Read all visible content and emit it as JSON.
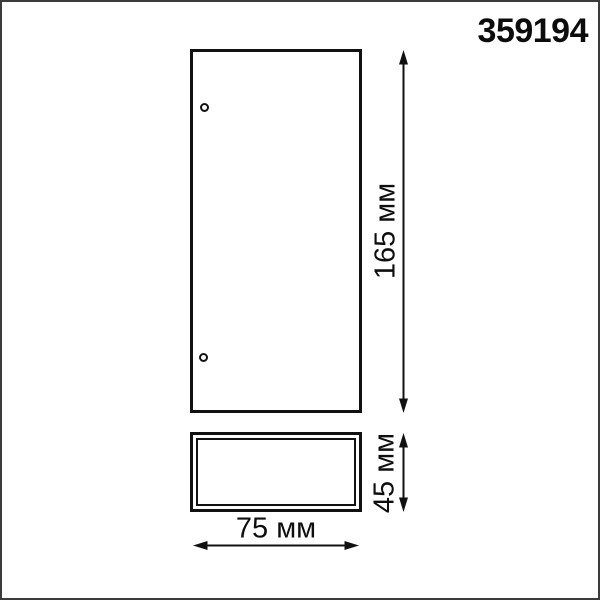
{
  "product": {
    "code": "359194"
  },
  "drawing": {
    "views": {
      "front": "front-view-outline",
      "side": "side-view-outline"
    },
    "dimensions": {
      "height": {
        "label": "165 мм",
        "value": 165,
        "unit": "мм"
      },
      "depth": {
        "label": "45 мм",
        "value": 45,
        "unit": "мм"
      },
      "width": {
        "label": "75 мм",
        "value": 75,
        "unit": "мм"
      }
    },
    "holes_count": 2
  },
  "colors": {
    "line": "#111111",
    "text": "#0c0c0c",
    "frame_border": "#3b3b3b",
    "background": "#ffffff"
  }
}
